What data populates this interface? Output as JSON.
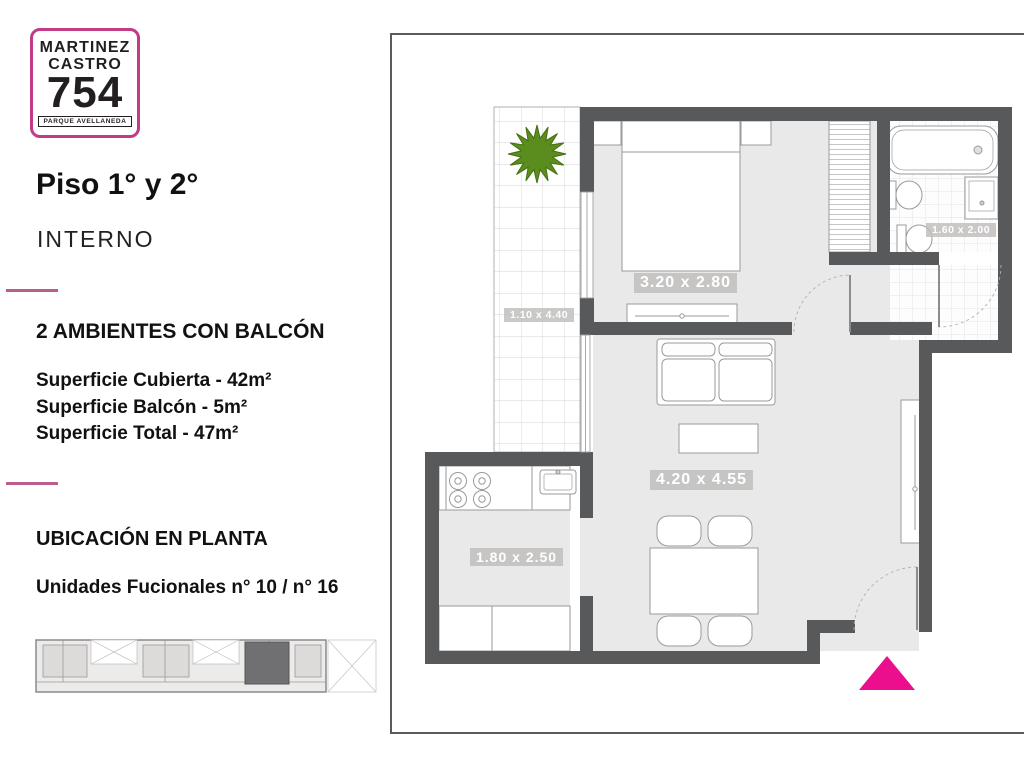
{
  "brand": {
    "line1": "MARTINEZ",
    "line2": "CASTRO",
    "number": "754",
    "tagline": "PARQUE AVELLANEDA"
  },
  "headings": {
    "floor": "Piso 1° y 2°",
    "category": "INTERNO"
  },
  "listing": {
    "type": "2 AMBIENTES CON BALCÓN",
    "areas": [
      "Superficie Cubierta - 42m²",
      "Superficie Balcón - 5m²",
      "Superficie Total - 47m²"
    ]
  },
  "location": {
    "heading": "UBICACIÓN EN PLANTA",
    "units": "Unidades Fucionales n° 10 / n° 16"
  },
  "plan": {
    "dim": {
      "balcony": "1.10 x 4.40",
      "bedroom": "3.20 x 2.80",
      "bathroom": "1.60 x 2.00",
      "living": "4.20 x 4.55",
      "kitchen": "1.80 x 2.50"
    }
  },
  "colors": {
    "wall": "#58595b",
    "floor": "#eae9e9",
    "accent_magenta": "#ec0f8d",
    "logo_border": "#c23b87",
    "divider_pink": "#b95f90",
    "plant_green": "#5a8c1e"
  }
}
